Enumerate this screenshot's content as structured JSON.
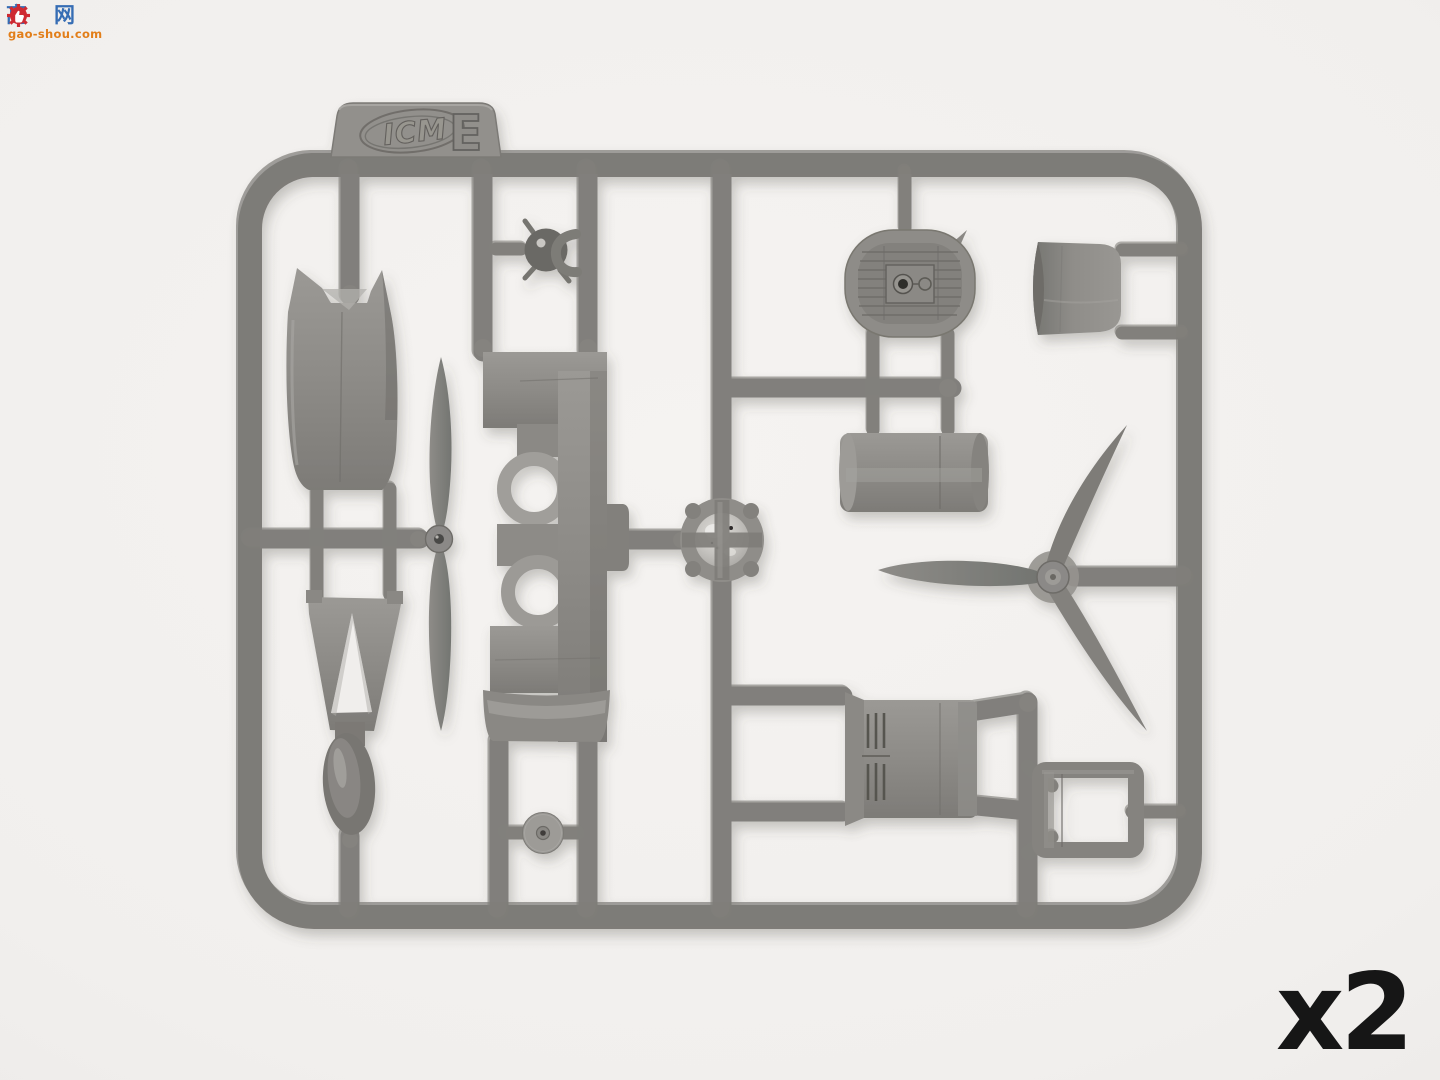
{
  "image": {
    "type": "photograph",
    "subject": "injection-molded plastic model kit sprue with aircraft parts"
  },
  "watermark": {
    "char_left": "高",
    "char_right": "网",
    "site": "gao-shou.com",
    "badge_icon": "thumbs-up-gear-icon",
    "colors": {
      "characters": "#2c67b2",
      "gear": "#cd2029",
      "site_text": "#e2790e"
    }
  },
  "sprue_tag": {
    "brand": "ICM",
    "letter": "E"
  },
  "quantity": {
    "label": "x2"
  },
  "colors": {
    "plastic_base": "#8d8b87",
    "plastic_dark": "#7a7874",
    "plastic_light": "#a3a19d",
    "background": "#f2f0ed",
    "quantity_text": "#161616"
  },
  "parts": [
    "fuselage-half",
    "two-blade-propeller",
    "windscreen-frame",
    "fuel-tank-oval",
    "spinner-ball",
    "cowling-sections-panel",
    "engine-front-disc",
    "radiator-grille",
    "exhaust-cylinder",
    "curved-cowl-panel",
    "three-blade-propeller",
    "louvered-cowling",
    "engine-mount-frame",
    "wheel-disc"
  ]
}
